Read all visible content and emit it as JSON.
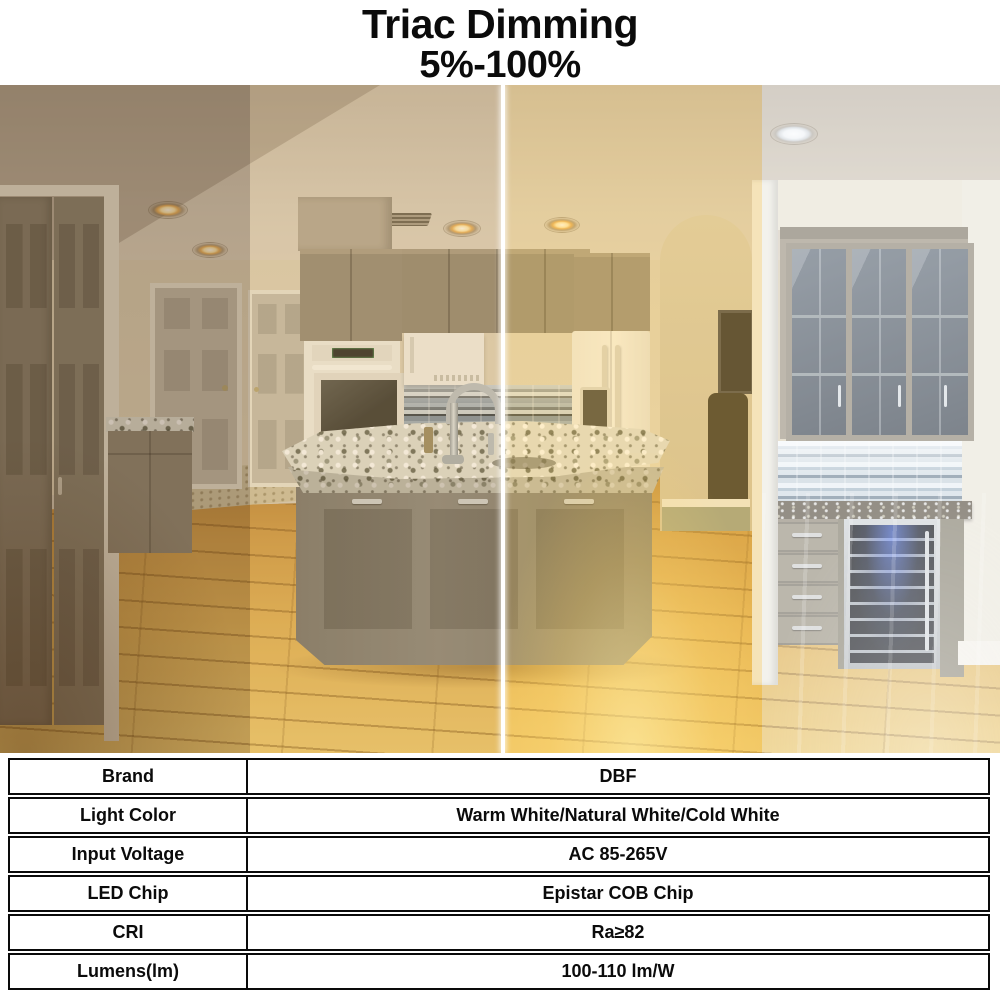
{
  "header": {
    "title": "Triac Dimming",
    "subtitle": "5%-100%"
  },
  "photo": {
    "sections": [
      {
        "name": "dim-warm",
        "tint": "rgba(98,64,24,0.32)"
      },
      {
        "name": "warm-white",
        "tint": "rgba(206,148,62,0.20)"
      },
      {
        "name": "bright-warm",
        "tint": "rgba(255,196,70,0.28)"
      },
      {
        "name": "cool-white",
        "tint": "rgba(244,248,252,0.30)"
      }
    ],
    "divider_color": "#ffffff"
  },
  "table": {
    "rows": [
      {
        "label": "Brand",
        "value": "DBF"
      },
      {
        "label": "Light Color",
        "value": "Warm White/Natural White/Cold White"
      },
      {
        "label": "Input Voltage",
        "value": "AC 85-265V"
      },
      {
        "label": "LED Chip",
        "value": "Epistar COB Chip"
      },
      {
        "label": "CRI",
        "value": "Ra≥82"
      },
      {
        "label": "Lumens(lm)",
        "value": "100-110 lm/W"
      }
    ]
  }
}
